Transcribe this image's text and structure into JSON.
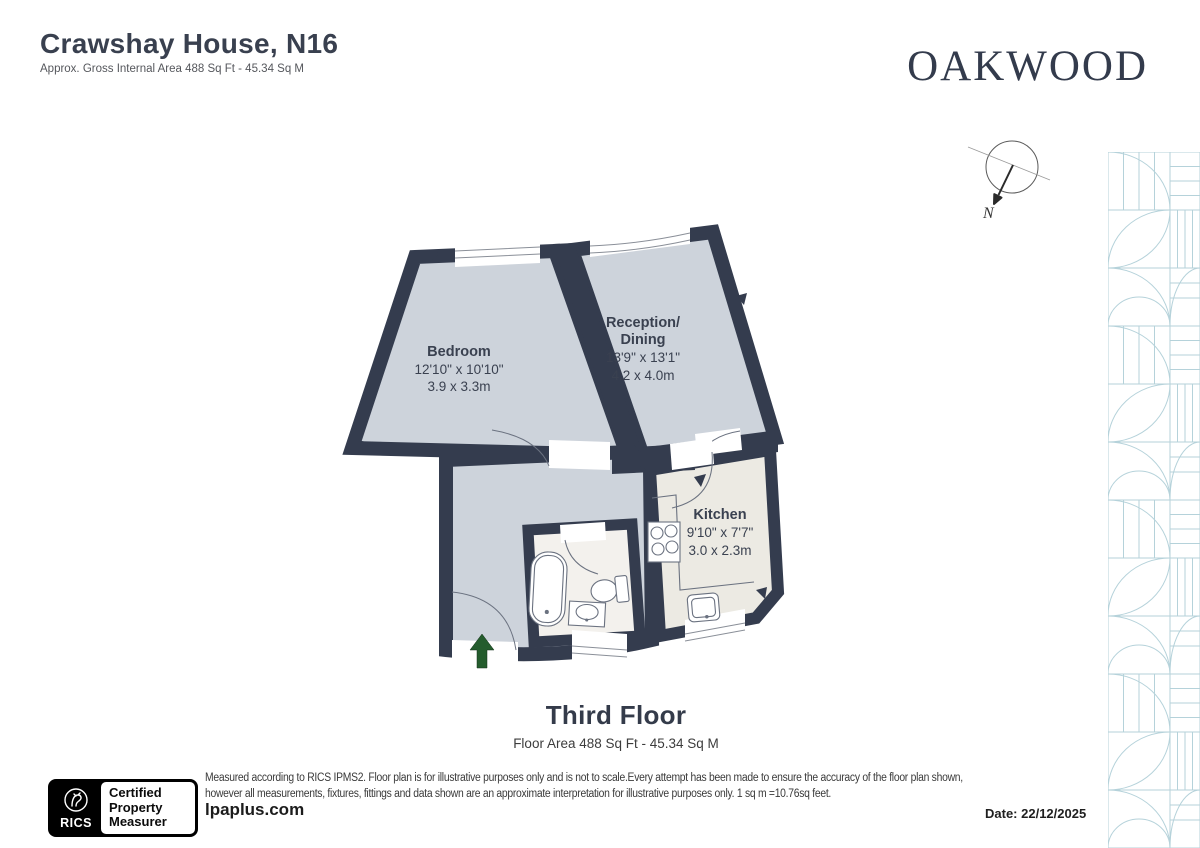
{
  "header": {
    "title": "Crawshay House, N16",
    "subtitle": "Approx. Gross Internal Area 488 Sq Ft - 45.34 Sq M"
  },
  "brand": {
    "name": "OAKWOOD"
  },
  "compass": {
    "north_label": "N"
  },
  "floorplan": {
    "rooms": [
      {
        "name": "Bedroom",
        "imperial": "12'10\" x 10'10\"",
        "metric": "3.9 x 3.3m"
      },
      {
        "name": "Reception/",
        "name_line2": "Dining",
        "imperial": "13'9\" x 13'1\"",
        "metric": "4.2 x 4.0m"
      },
      {
        "name": "Kitchen",
        "imperial": "9'10\" x 7'7\"",
        "metric": "3.0 x 2.3m"
      }
    ]
  },
  "floor_summary": {
    "title": "Third Floor",
    "subtitle": "Floor Area 488 Sq Ft - 45.34 Sq M"
  },
  "footer": {
    "rics_badge": {
      "org": "RICS",
      "cert_line1": "Certified",
      "cert_line2": "Property",
      "cert_line3": "Measurer"
    },
    "disclaimer_line1": "Measured according to RICS IPMS2. Floor plan is for illustrative purposes only and is not to scale.Every attempt has been made to ensure the accuracy of the floor plan shown,",
    "disclaimer_line2": "however all measurements, fixtures, fittings and data shown are an approximate interpretation for illustrative purposes only. 1 sq m =10.76sq feet.",
    "website": "lpaplus.com",
    "date": "Date: 22/12/2025"
  },
  "colors": {
    "wall_navy": "#343C4E",
    "room_fill": "#CDD3DB",
    "kitchen_fill": "#ECEAE3",
    "bath_fill": "#F3F1ED",
    "pattern_blue": "#B5D2DA",
    "entry_arrow_green": "#245C2D"
  }
}
